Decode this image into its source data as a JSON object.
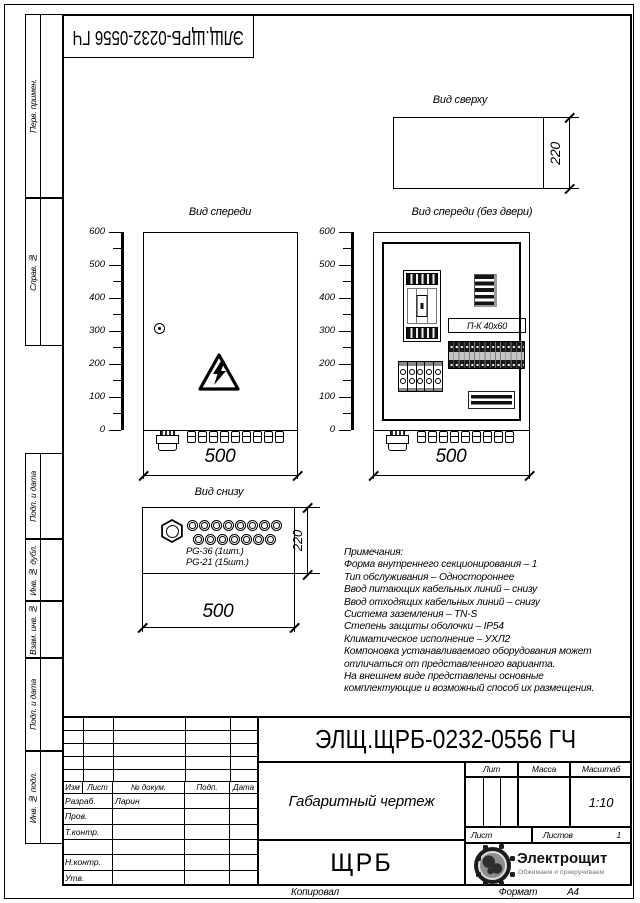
{
  "designation": "ЭЛЩ.ЩРБ-0232-0556 ГЧ",
  "margin_labels": [
    "Перв. примен.",
    "Справ. №",
    "Подп. и дата",
    "Инв. № дубл.",
    "Взам. инв. №",
    "Подп. и дата",
    "Инв. № подл."
  ],
  "ruler_labels": [
    "600",
    "500",
    "400",
    "300",
    "200",
    "100",
    "0"
  ],
  "views": {
    "top": {
      "title": "Вид сверху",
      "depth": "220"
    },
    "front": {
      "title": "Вид спереди",
      "width": "500"
    },
    "front_open": {
      "title": "Вид спереди (без двери)",
      "width": "500",
      "duct_label": "П-К 40x60"
    },
    "bottom": {
      "title": "Вид снизу",
      "width": "500",
      "depth": "220",
      "gland_large_label": "PG-36 (1шт.)",
      "gland_small_label": "PG-21 (15шт.)",
      "holes_top_row": 8,
      "holes_bottom_row": 7
    }
  },
  "counts": {
    "cable_glands_small": 9,
    "terminal_modules": 15,
    "fuse_modules": 5
  },
  "notes": {
    "title": "Примечания:",
    "lines": [
      "Форма внутреннего секционирования – 1",
      "Тип обслуживания – Одностороннее",
      "Ввод питающих кабельных линий – снизу",
      "Ввод отходящих кабельных линий – снизу",
      "Система заземления – TN-S",
      "Степень защиты оболочки – IP54",
      "Климатическое исполнение – УХЛ2",
      "Компоновка устанавливаемого оборудования может",
      "отличаться от представленного варианта.",
      "На внешнем виде представлены основные",
      "комплектующие и возможный способ их размещения."
    ]
  },
  "title_block": {
    "designation": "ЭЛЩ.ЩРБ-0232-0556 ГЧ",
    "doc_type": "Габаритный чертеж",
    "product": "ЩРБ",
    "columns": [
      "Изм",
      "Лист",
      "№ докум.",
      "Подп.",
      "Дата"
    ],
    "rows": [
      [
        "Разраб.",
        "Ларин"
      ],
      [
        "Пров.",
        ""
      ],
      [
        "Т.контр.",
        ""
      ],
      [
        "",
        ""
      ],
      [
        "Н.контр.",
        ""
      ],
      [
        "Утв.",
        ""
      ]
    ],
    "lit": "Лит",
    "mass": "Масса",
    "scale": "Масштаб",
    "scale_value": "1:10",
    "sheet": "Лист",
    "sheets": "Листов",
    "sheets_value": "1",
    "copied": "Копировал",
    "format": "Формат",
    "format_value": "А4"
  },
  "logo": {
    "name": "Электрощит",
    "tagline": "Обжимаем и прикручиваем"
  }
}
